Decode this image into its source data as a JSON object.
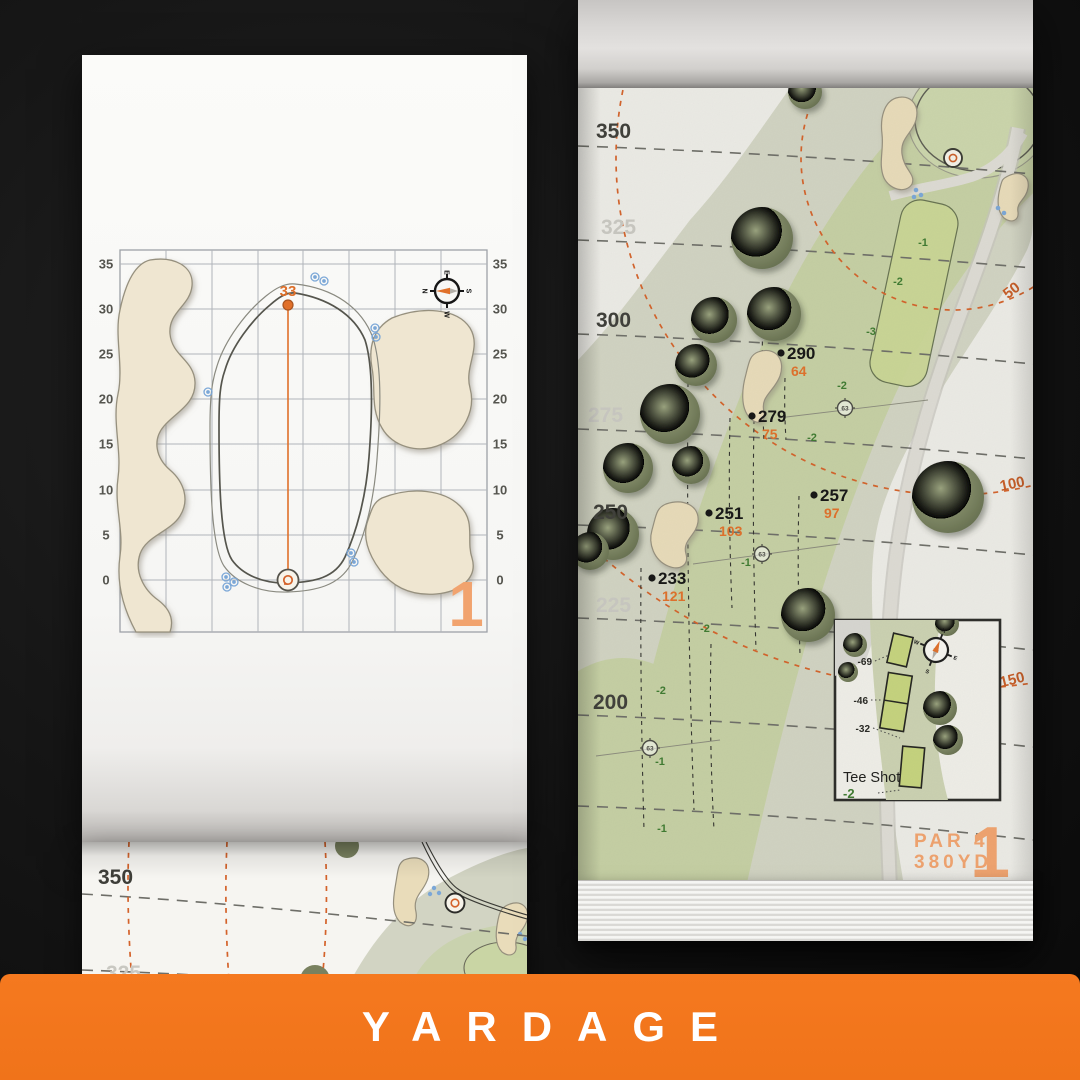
{
  "banner": {
    "title": "YARDAGE",
    "bg_color": "#F0731A",
    "text_color": "#FFFFFF"
  },
  "palette": {
    "accent_orange": "#E0702A",
    "soft_orange": "#F1A36E",
    "fairway_green": "#C6D0A4",
    "rough_green": "#D2D4C3",
    "landing_zone_green": "#CBD795",
    "tree_green": "#6D7656",
    "sand": "#EFE6D1",
    "page_white": "#EDECE7",
    "background_black": "#161616"
  },
  "detail_page": {
    "page_number": "1",
    "pin_depth_label": "33",
    "axis_ticks_left": [
      "35",
      "30",
      "25",
      "20",
      "15",
      "10",
      "5",
      "0"
    ],
    "axis_ticks_right": [
      "35",
      "30",
      "25",
      "20",
      "15",
      "10",
      "5",
      "0"
    ],
    "compass": {
      "north": "N",
      "east": "E",
      "south": "S",
      "west": "W"
    }
  },
  "hole_page": {
    "page_number": "1",
    "par_label": "PAR 4",
    "distance_label": "380YD",
    "distance_bands": [
      {
        "value": "350",
        "tone": "dark"
      },
      {
        "value": "325",
        "tone": "light"
      },
      {
        "value": "300",
        "tone": "dark"
      },
      {
        "value": "275",
        "tone": "light"
      },
      {
        "value": "250",
        "tone": "dark"
      },
      {
        "value": "225",
        "tone": "light"
      },
      {
        "value": "200",
        "tone": "dark"
      }
    ],
    "arc_labels": [
      "50",
      "100",
      "150"
    ],
    "carry_points": [
      {
        "carry": "290",
        "to_green": "64"
      },
      {
        "carry": "279",
        "to_green": "75"
      },
      {
        "carry": "257",
        "to_green": "97"
      },
      {
        "carry": "251",
        "to_green": "103"
      },
      {
        "carry": "233",
        "to_green": "121"
      }
    ],
    "sprinkler_heads": [
      "63",
      "63",
      "63"
    ],
    "elevation_marks": [
      "-1",
      "-2",
      "-3",
      "-2",
      "-2",
      "-1",
      "-2",
      "-2",
      "-1",
      "-1"
    ],
    "tee_inset": {
      "title": "Tee Shot",
      "elevation": "-2",
      "tee_offsets": [
        "-69",
        "-46",
        "-32"
      ],
      "compass": {
        "north": "N",
        "east": "E",
        "south": "S",
        "west": "W"
      }
    }
  },
  "flipped_page": {
    "distance_bands": [
      "350",
      "325"
    ]
  }
}
